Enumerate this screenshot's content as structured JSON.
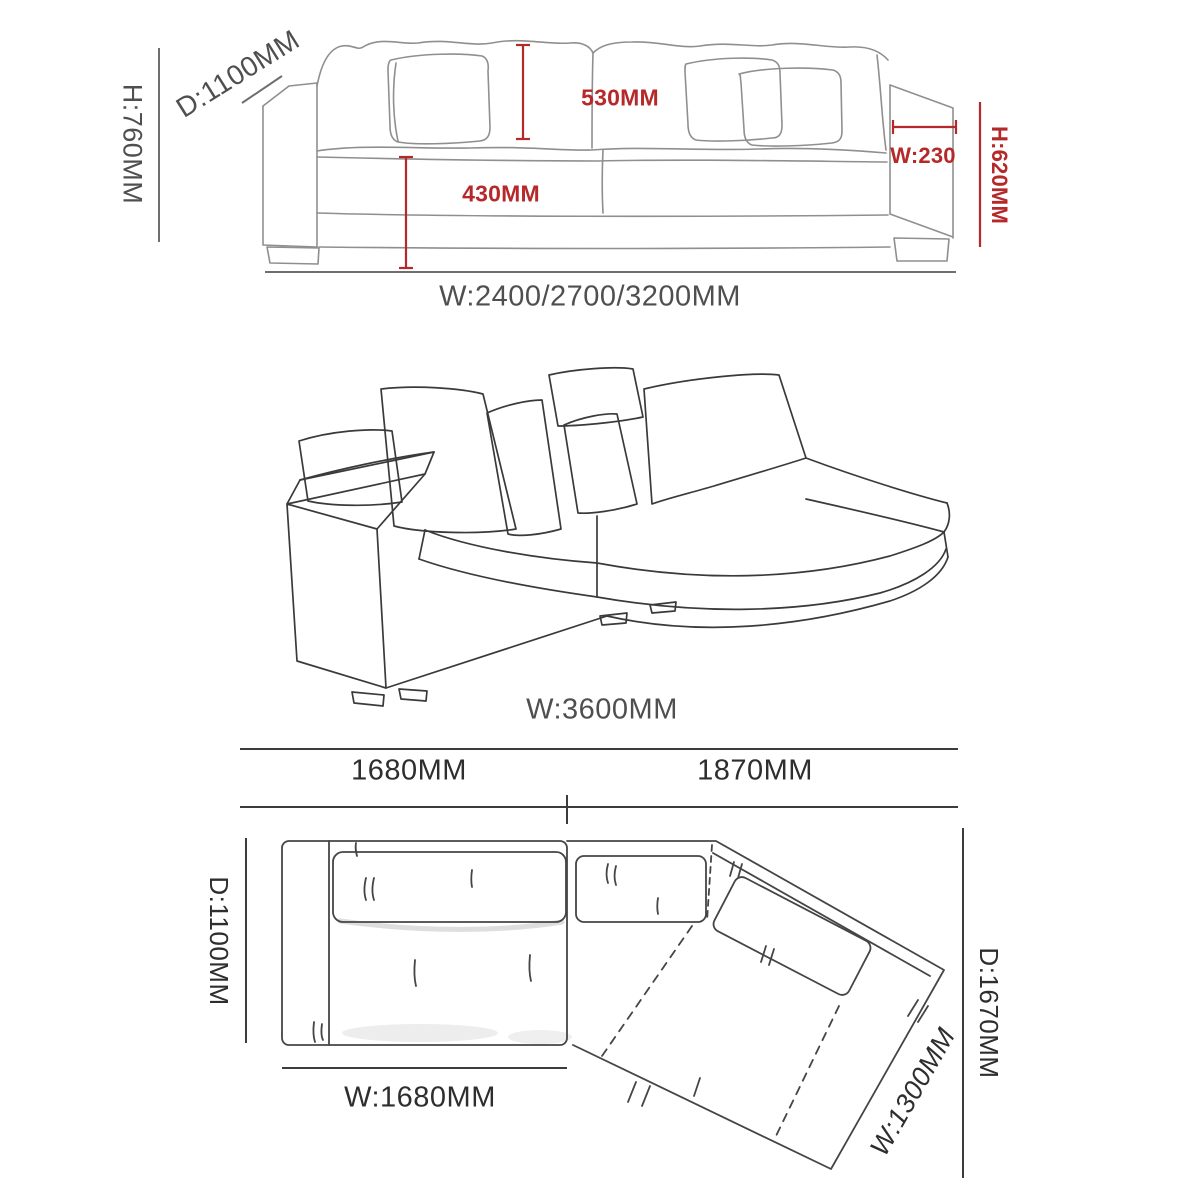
{
  "diagram_title": "sofa-dimension-drawing",
  "front_view": {
    "overall_height": "H:760MM",
    "depth": "D:1100MM",
    "back_cushion_height": "530MM",
    "seat_height": "430MM",
    "armrest_width": "W:230",
    "armrest_height": "H:620MM",
    "width_options": "W:2400/2700/3200MM"
  },
  "perspective_view": {
    "total_width": "W:3600MM"
  },
  "plan_view": {
    "left_section_width": "1680MM",
    "right_section_width": "1870MM",
    "left_depth": "D:1100MM",
    "left_width": "W:1680MM",
    "chaise_width": "W:1300MM",
    "total_depth": "D:1670MM"
  },
  "colors": {
    "dimension_red": "#b5292a",
    "label_gray": "#4f4f4f",
    "label_dark": "#2e2e2e",
    "sketch_light_gray": "#8f8f8f",
    "sketch_dark_gray": "#3a3a3a"
  }
}
